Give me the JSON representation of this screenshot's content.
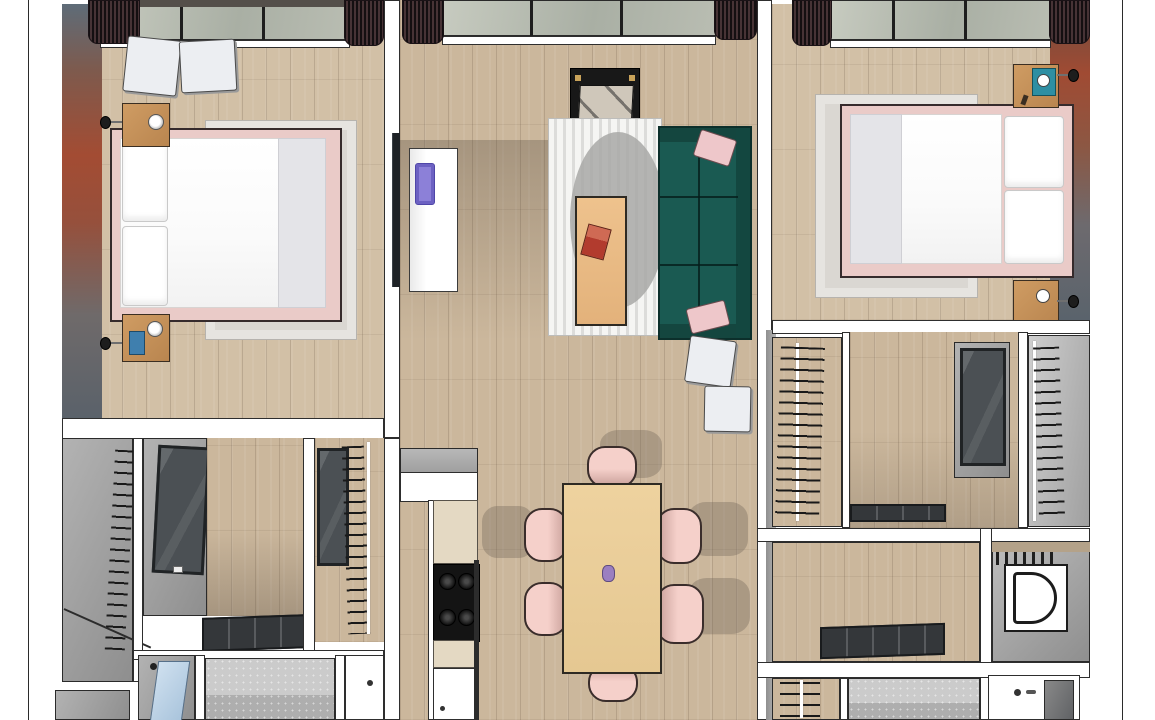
{
  "scene": {
    "title": "3D top-down render of a two-bedroom apartment floor plan",
    "page": {
      "background": "#ffffff",
      "margin_rule_lines": 2,
      "rule_line_color": "#2b2b2b"
    },
    "rooms": [
      {
        "id": "bedroom-left",
        "label": "Left bedroom",
        "features": [
          "terracotta accent wall",
          "window with dark curtains",
          "double bed with pink frame and white duvet",
          "grey area rug",
          "two wooden nightstands with lamps",
          "two wall sconces",
          "two white poufs",
          "wall-mounted TV",
          "blue book on nightstand"
        ]
      },
      {
        "id": "living-room",
        "label": "Living room",
        "features": [
          "window with dark curtains",
          "teal sofa with two pink cushions",
          "striped rug with grey circle motif",
          "wooden coffee table with red book",
          "TV on black stand",
          "white refrigerator with purple display",
          "two white poufs"
        ]
      },
      {
        "id": "bedroom-right",
        "label": "Right bedroom",
        "features": [
          "terracotta accent wall",
          "window with dark curtains",
          "double bed with pink frame and white duvet",
          "grey area rug",
          "two wooden nightstands",
          "teal tray with cup",
          "two wall sconces"
        ]
      },
      {
        "id": "dining-area",
        "label": "Dining area",
        "features": [
          "wooden dining table",
          "six pink chairs",
          "small purple vase"
        ]
      },
      {
        "id": "kitchen",
        "label": "Kitchen run",
        "features": [
          "white cabinets",
          "cream worktop",
          "black gas hob with four burners",
          "white appliance front"
        ]
      },
      {
        "id": "hallway-closets-left",
        "label": "Hallway with closets",
        "features": [
          "grey wardrobe with hangers",
          "dark glass wardrobe door",
          "wood hallway floor",
          "flat sliding glass door on track",
          "closet with clothes rail"
        ]
      },
      {
        "id": "bathroom-left",
        "label": "Left bathroom",
        "features": [
          "shower with blue glass door",
          "grey tiled floor",
          "white fixture with drain"
        ]
      },
      {
        "id": "closets-right",
        "label": "Right walk-in closets",
        "features": [
          "closet with hanging clothes",
          "dark glass sliding wardrobe",
          "white closet with rail",
          "floor door track"
        ]
      },
      {
        "id": "toilet-room",
        "label": "Toilet room",
        "features": [
          "white toilet",
          "wall radiator",
          "wood shelf"
        ]
      },
      {
        "id": "bathroom-right",
        "label": "Right bathroom",
        "features": [
          "grey tiled floor",
          "white basin counter with faucet",
          "closet with hangers"
        ]
      }
    ],
    "counts": {
      "bedrooms": 2,
      "dining_chairs": 6,
      "white_poufs": 4,
      "nightstands": 4,
      "wall_sconces": 4,
      "windows": 3
    }
  },
  "colors": {
    "floor_wood": "#cbb79c",
    "wall_white": "#ffffff",
    "wall_gray_face": "#9a9a9a",
    "outline": "#2a2a2a",
    "accent_terracotta": "#a34c33",
    "accent_gray_blue": "#5e6c78",
    "curtain_dark": "#2c2125",
    "window_glazing": "#b9bdb2",
    "sofa_teal": "#1a5a52",
    "cushion_pink": "#eec7ca",
    "chair_pink": "#f5d0ca",
    "bed_frame_pink": "#eacbc8",
    "duvet_white": "#ffffff",
    "rug_gray": "#dad7d2",
    "rug_stripe": "#f5f5f3",
    "rug_circle": "#a8a8a6",
    "dining_table_wood": "#ead09e",
    "nightstand_wood": "#c6935f",
    "fridge_display_purple": "#8c80d8",
    "book_red": "#b23b2e",
    "tray_teal": "#2e8fa3",
    "book_blue": "#3f7fae",
    "vase_purple": "#9b7fc0",
    "shower_glass_blue": "#b9cfe4",
    "tile_gray": "#cbcbcb",
    "hob_black": "#141414",
    "worktop_cream": "#e4d9c3",
    "glass_wardrobe_dark": "#4b5054"
  }
}
